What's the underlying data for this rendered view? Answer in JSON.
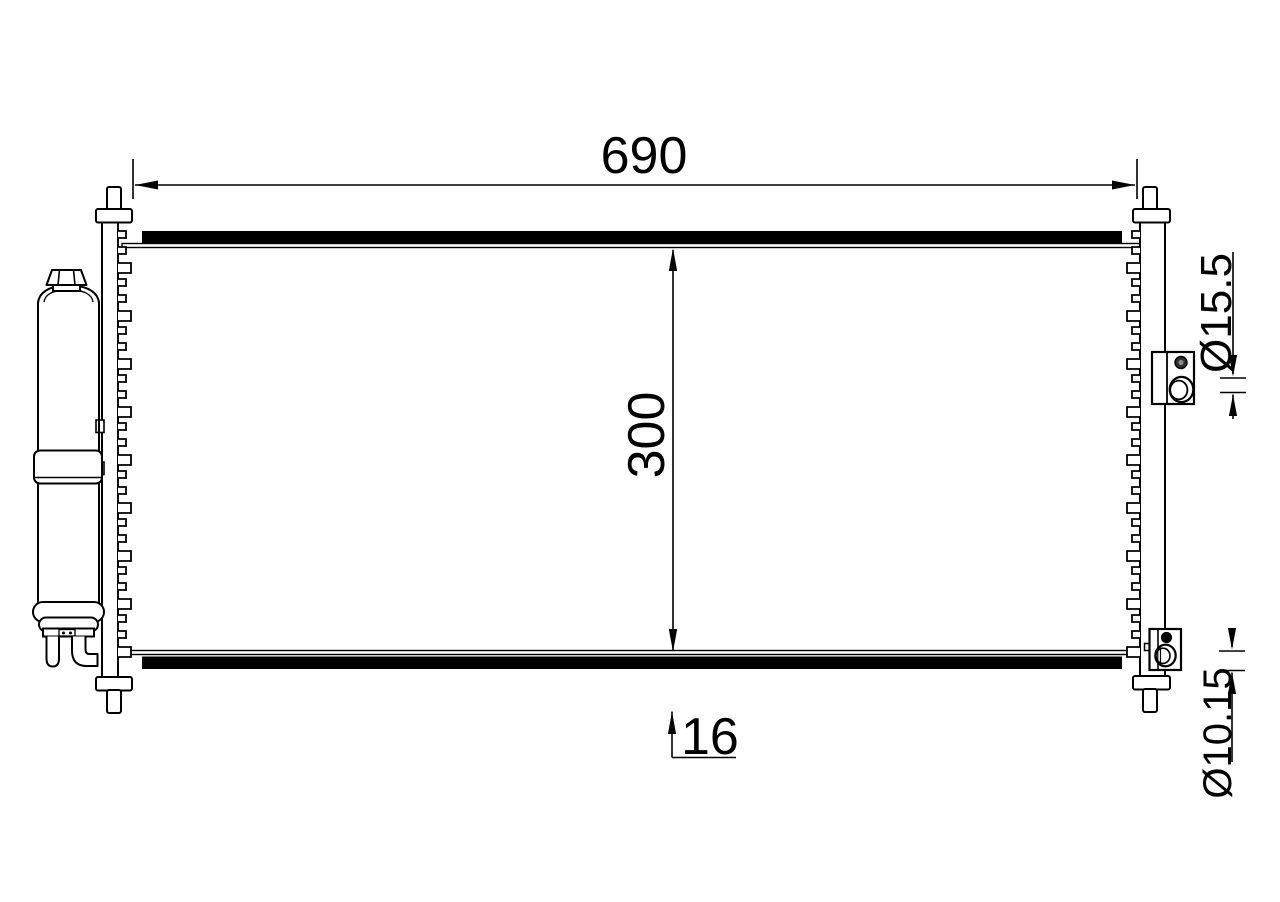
{
  "drawing": {
    "background_color": "#ffffff",
    "line_color": "#000000",
    "labels": {
      "width": "690",
      "core_height": "300",
      "core_depth": "16",
      "upper_port_diameter": "Ø15.5",
      "lower_port_diameter": "Ø10.15"
    }
  }
}
